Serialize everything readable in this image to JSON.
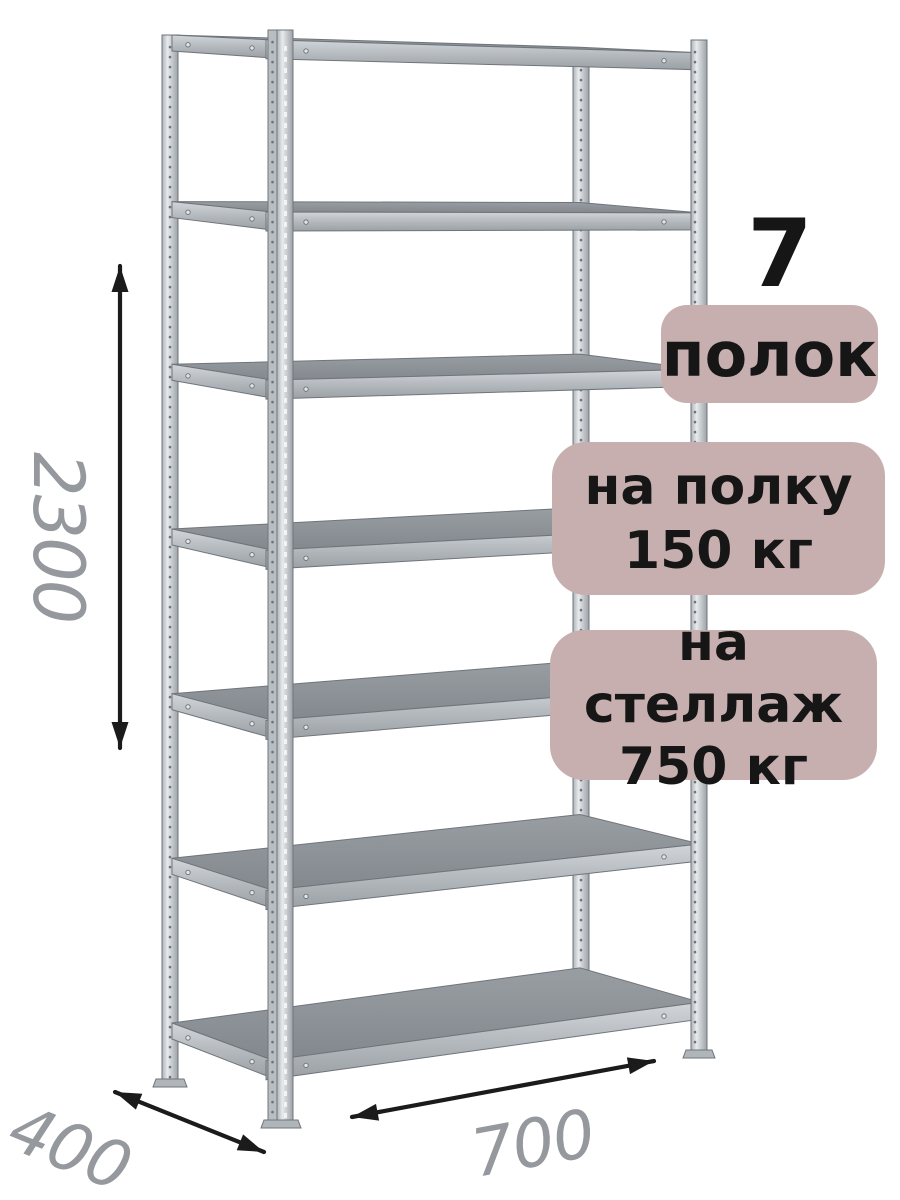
{
  "badges": {
    "shelf_count": {
      "number": "7",
      "label": "полок"
    },
    "per_shelf": {
      "line1": "на полку",
      "line2": "150 кг"
    },
    "per_rack": {
      "line1": "на стеллаж",
      "line2": "750 кг"
    }
  },
  "dimensions": {
    "height": "2300",
    "depth": "400",
    "width": "700"
  },
  "colors": {
    "background": "#ffffff",
    "badge_bg": "#c7afaf",
    "badge_text": "#161616",
    "dimension_text": "#95999d",
    "arrow": "#1b1b1b",
    "metal_light": "#e8ebed",
    "metal_mid": "#b7bcc1",
    "metal_dark": "#82888d",
    "metal_outline": "#6f757b"
  }
}
